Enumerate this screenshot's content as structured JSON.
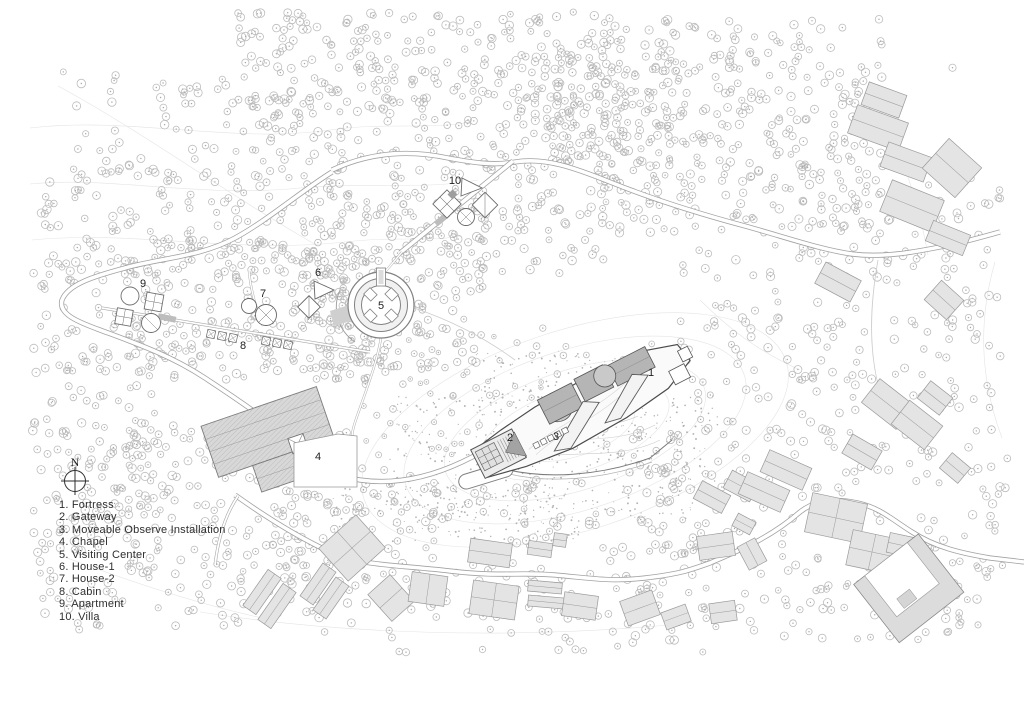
{
  "compass": {
    "north_label": "N"
  },
  "legend": {
    "items": [
      {
        "number": "1",
        "label": "Fortress",
        "text": "1. Fortress"
      },
      {
        "number": "2",
        "label": "Gateway",
        "text": "2. Gateway"
      },
      {
        "number": "3",
        "label": "Moveable Observe Installation",
        "text": "3. Moveable Observe Installation"
      },
      {
        "number": "4",
        "label": "Chapel",
        "text": "4. Chapel"
      },
      {
        "number": "5",
        "label": "Visiting Center",
        "text": "5. Visiting Center"
      },
      {
        "number": "6",
        "label": "House-1",
        "text": "6. House-1"
      },
      {
        "number": "7",
        "label": "House-2",
        "text": "7. House-2"
      },
      {
        "number": "8",
        "label": "Cabin",
        "text": "8. Cabin"
      },
      {
        "number": "9",
        "label": "Apartment",
        "text": "9. Apartment"
      },
      {
        "number": "10",
        "label": "Villa",
        "text": "10. Villa"
      }
    ]
  },
  "map": {
    "markers": [
      {
        "number": "1",
        "name": "fortress"
      },
      {
        "number": "2",
        "name": "gateway"
      },
      {
        "number": "3",
        "name": "moveable-observe-installation"
      },
      {
        "number": "4",
        "name": "chapel"
      },
      {
        "number": "5",
        "name": "visiting-center"
      },
      {
        "number": "6",
        "name": "house-1"
      },
      {
        "number": "7",
        "name": "house-2"
      },
      {
        "number": "8",
        "name": "cabin"
      },
      {
        "number": "9",
        "name": "apartment"
      },
      {
        "number": "10",
        "name": "villa"
      }
    ],
    "colors": {
      "background": "#ffffff",
      "tree_outline": "#bcbcbc",
      "contour_line": "#e4e4e4",
      "road_casing": "#a2a2a2",
      "village_building_fill": "#e4e4e4",
      "fortress_roof_fill": "#b5b5b5",
      "hatched_roof_fill": "#d8d8d8",
      "text": "#2e2e2e"
    }
  }
}
